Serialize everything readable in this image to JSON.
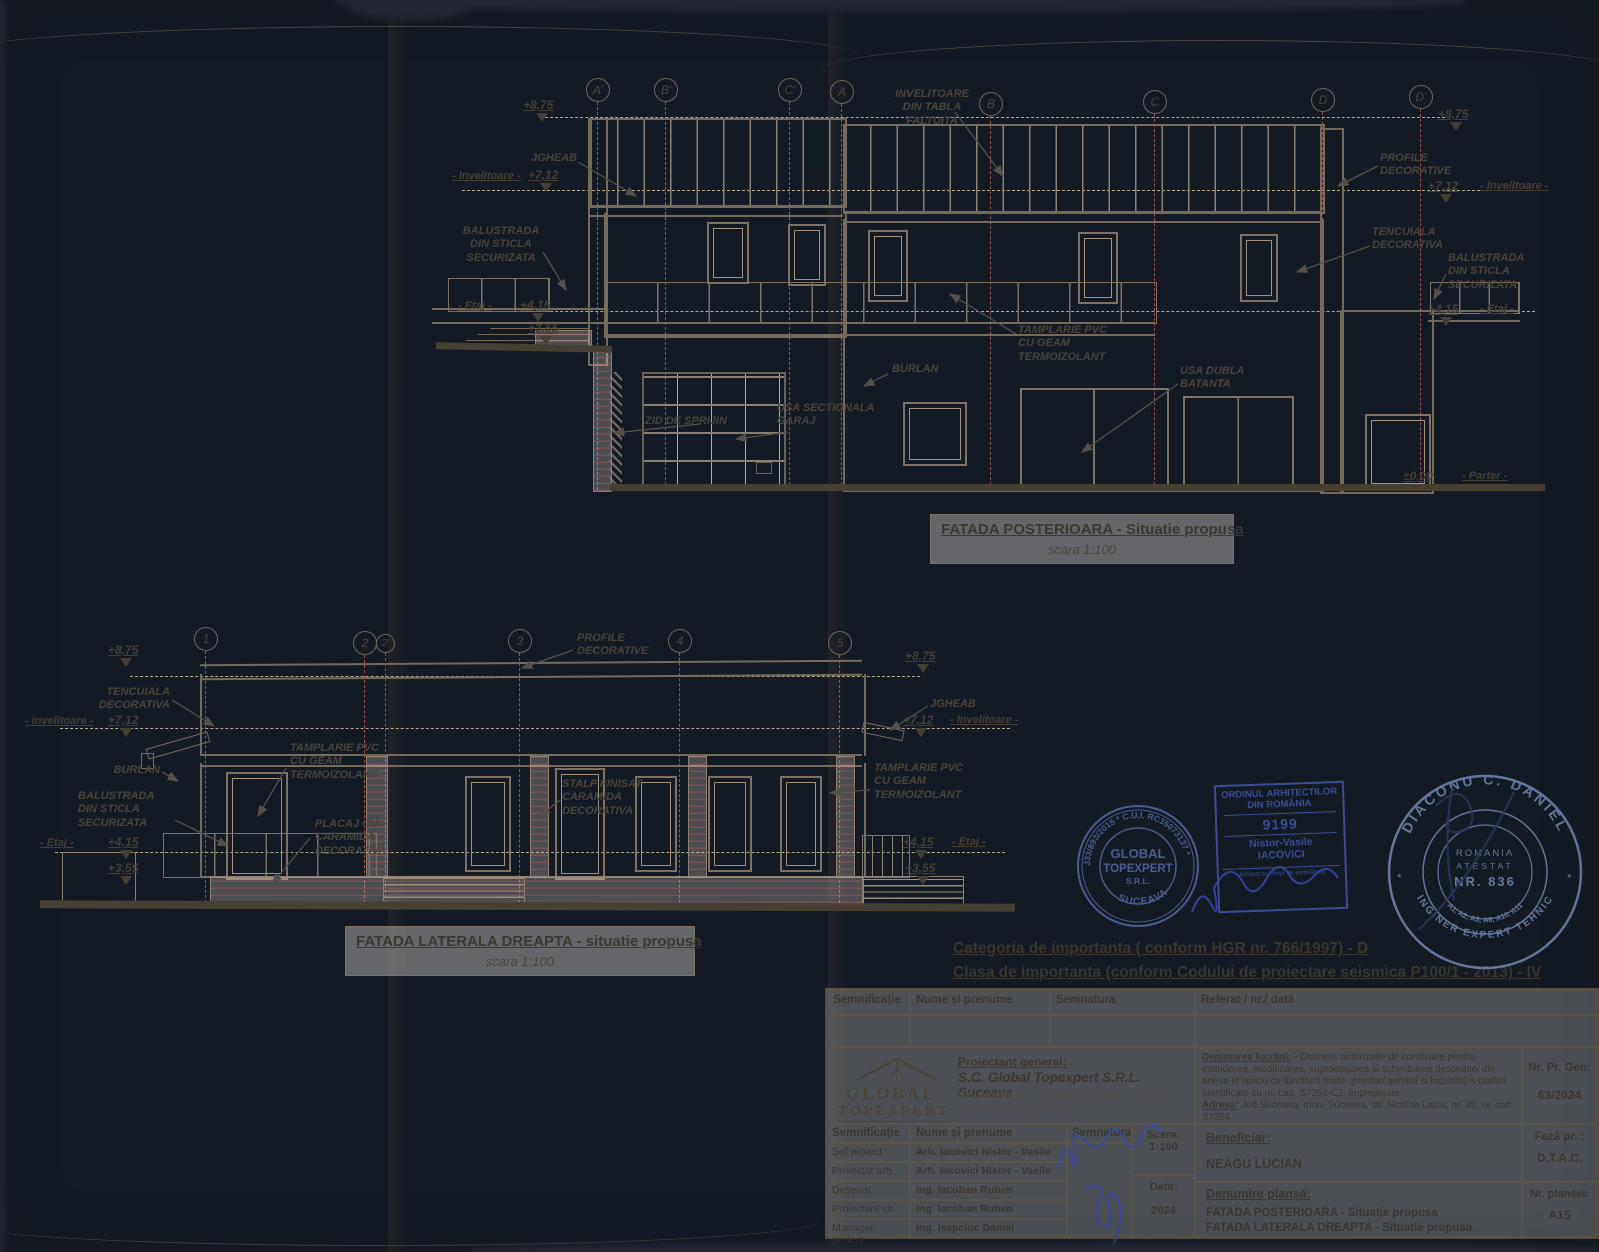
{
  "levels": {
    "l875": "+8,75",
    "l712": "+7,12",
    "l415": "+4,15",
    "l355": "+3,55",
    "l000": "±0,00",
    "invelitoare": "- Invelitoare -",
    "etaj": "- Etaj -",
    "parter": "- Parter -"
  },
  "facade_rear": {
    "title": "FATADA POSTERIOARA - Situatie propusa",
    "scale": "scara 1:100",
    "axes": [
      "A'",
      "B'",
      "C'",
      "A",
      "B",
      "C",
      "D",
      "D'"
    ],
    "ann": {
      "invelitoare_tabla": "INVELITOARE\nDIN TABLA\nFALTUITA",
      "jgheab": "JGHEAB",
      "balustrada": "BALUSTRADA\nDIN STICLA\nSECURIZATA",
      "zid": "ZID DE SPRIJIN",
      "usa_sectionala": "USA SECTIONALA\nGARAJ",
      "burlan": "BURLAN",
      "tamplarie": "TAMPLARIE PVC\nCU GEAM\nTERMOIZOLANT",
      "usa_dubla": "USA DUBLA\nBATANTA",
      "profile": "PROFILE\nDECORATIVE",
      "tencuiala": "TENCUIALA\nDECORATIVA",
      "balustrada_dr": "BALUSTRADA\nDIN STICLA\nSECURIZATA"
    }
  },
  "facade_side": {
    "title": "FATADA LATERALA DREAPTA - situatie propusa",
    "scale": "scara 1:100",
    "axes": [
      "1",
      "2",
      "2'",
      "3",
      "4",
      "5"
    ],
    "ann": {
      "tencuiala": "TENCUIALA\nDECORATIVA",
      "burlan": "BURLAN",
      "balustrada": "BALUSTRADA\nDIN STICLA\nSECURIZATA",
      "tamplarie": "TAMPLARIE PVC\nCU GEAM\nTERMOIZOLANT",
      "placaj": "PLACAJ CU\nCARAMIDA\nDECORATIVA",
      "profile": "PROFILE\nDECORATIVE",
      "stalp": "STALP FINISAT\nCARAMIDA\nDECORATIVA",
      "tamplarie_dr": "TAMPLARIE PVC\nCU GEAM\nTERMOIZOLANT",
      "jgheab": "JGHEAB"
    }
  },
  "importance": {
    "line1": "Categoria de importanta ( conform HGR nr. 766/1997)  -  D",
    "line2": "Clasa de importanta  (conform Codului de proiectare seismica P100/1 - 2013) - IV"
  },
  "stamps": {
    "company": {
      "ring": "J33/893/2015 * C.U.I. RC35073137 *",
      "name1": "GLOBAL",
      "name2": "TOPEXPERT",
      "name3": "S.R.L.",
      "city": "SUCEAVA"
    },
    "oar": {
      "org1": "ORDINUL ARHITECTILOR",
      "org2": "DIN ROMÂNIA",
      "number": "9199",
      "name1": "Nistor-Vasile",
      "name2": "IACOVICI",
      "footer": "Arhitect cu drept de semnătură"
    },
    "expert": {
      "ring_top": "DIACONU C. DANIEL",
      "ring_bottom": "INGINER EXPERT TEHNIC",
      "country": "ROMANIA",
      "cert": "ATESTAT",
      "number": "NR. 836",
      "domains": "A1, A2, A3, A8, A10, A11",
      "star_left": "*",
      "star_right": "*"
    }
  },
  "titleblock": {
    "header": [
      "Semnificație",
      "Nume și prenume",
      "Semnatura",
      "Referat / nr./ dată"
    ],
    "logo1": "GLOBAL",
    "logo2": "TOPEXPERT",
    "proiectant_label": "Proiectant general:",
    "proiectant_name": "S.C. Global Topexpert S.R.L. Suceava",
    "proiectant_addr": "Jud. Suceava, loc. Sfantu Ilie, Str. Victoriei, nr. 18E",
    "proiectant_reg": "J33/893/2015 CUI: 35073137",
    "denumire_label": "Denumirea lucrării:",
    "denumire_text": "- Obtinere autorizatie de construire pentru extinderea, modificarea, supraetajarea si schimbarea destinatiei din anexa in spatiu cu functiuni mixte (prestari servicii si locuinta) a cladirii identificate cu nr. cad. S7254-C2, imprejmuire",
    "adresa_label": "Adresa:",
    "adresa_text": "Jud.Suceava, mun. Suceava, str. Nicolae Labis, nr. 35, nr. cad. S7254",
    "nr_pr_label": "Nr. Pr. Gen:",
    "nr_pr_value": "63/2024",
    "scara_label": "Scara:",
    "scara_value": "1:100",
    "data_label": "Data:",
    "data_value": "2024",
    "rows": [
      {
        "role": "Șef  proiect",
        "name": "Arh. Iacovici Nistor - Vasile"
      },
      {
        "role": "Proiectat arh.",
        "name": "Arh. Iacovici Nistor - Vasile"
      },
      {
        "role": "Desenat",
        "name": "Ing. Iacoban Ruben"
      },
      {
        "role": "Proiectant str.",
        "name": "Ing. Iacoban Ruben"
      },
      {
        "role": "Manager proiect",
        "name": "Ing. Isepciuc Daniel"
      }
    ],
    "beneficiar_label": "Beneficiar:",
    "beneficiar_name": "NEAGU LUCIAN",
    "faza_label": "Fază  pr. :",
    "faza_value": "D.T.A.C.",
    "plansa_label": "Denumire planșă:",
    "plansa1": "FATADA POSTERIOARA - Situatie propusa",
    "plansa2": "FATADA LATERALA DREAPTA - Situatie propusa",
    "nr_plansei_label": "Nr. planșei:",
    "nr_plansei_value": "A15"
  }
}
